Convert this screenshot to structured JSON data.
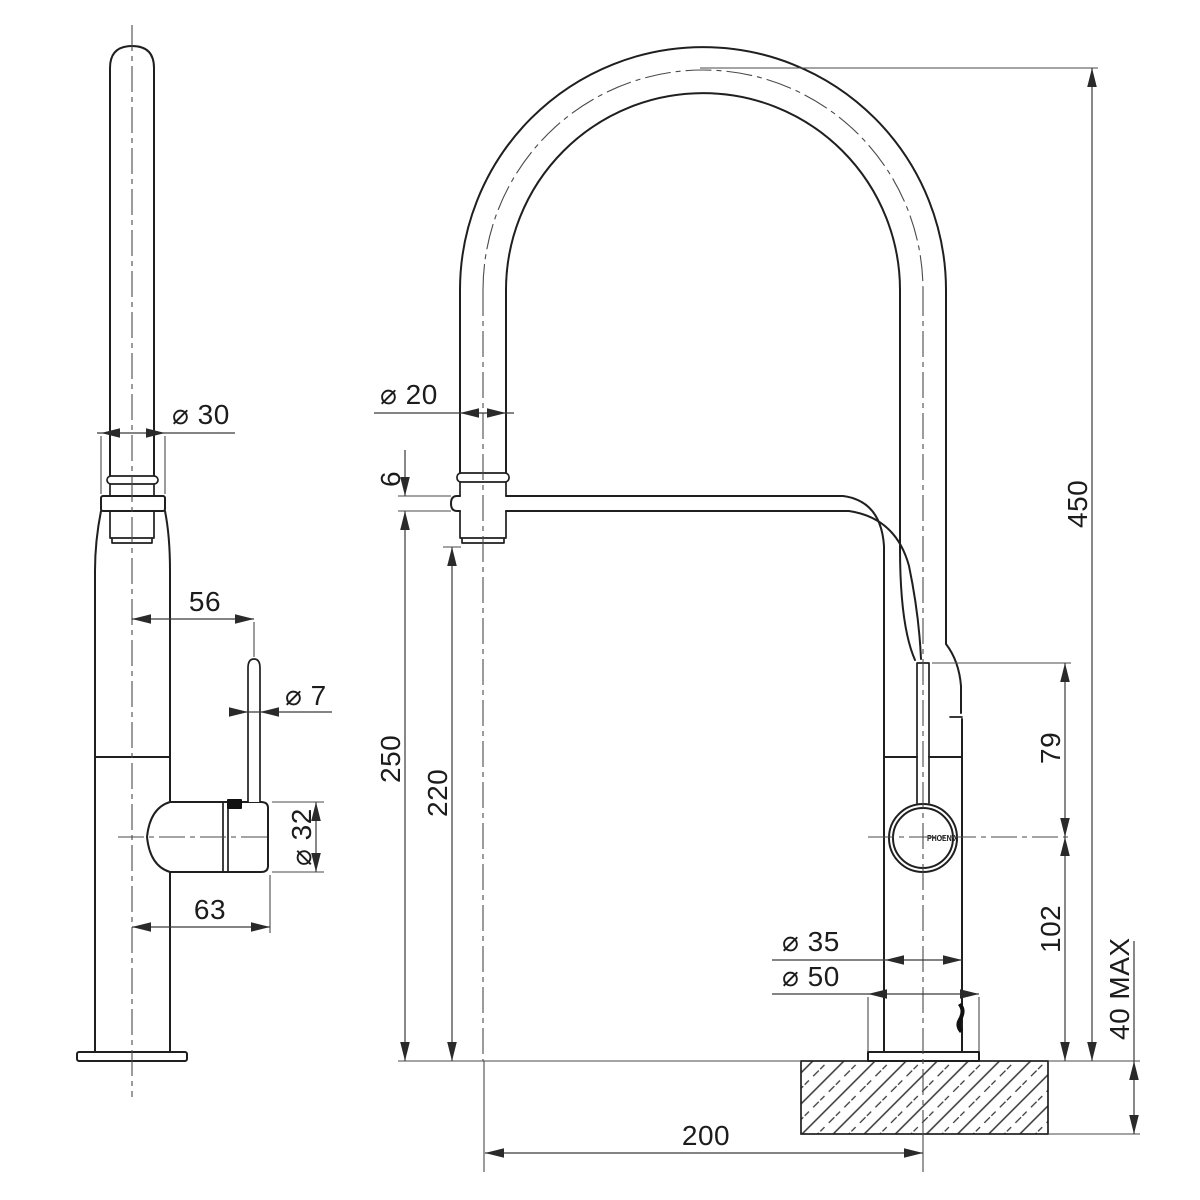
{
  "drawing": {
    "brand_label": "PHOENIX",
    "left_view": {
      "spray_handle_diameter": "⌀ 30",
      "lever_offset": "56",
      "lever_rod_diameter": "⌀ 7",
      "handle_body_diameter": "⌀ 32",
      "handle_length": "63"
    },
    "front_view": {
      "spout_tube_diameter": "⌀ 20",
      "support_arm_thickness": "6",
      "arm_height_above_bench": "250",
      "outlet_height_above_bench": "220",
      "overall_height": "450",
      "lever_top_to_knob_center": "79",
      "knob_center_to_bench": "102",
      "body_diameter": "⌀ 35",
      "base_flange_diameter": "⌀ 50",
      "bench_thickness_limit": "40 MAX",
      "centre_to_centre_reach": "200"
    }
  }
}
